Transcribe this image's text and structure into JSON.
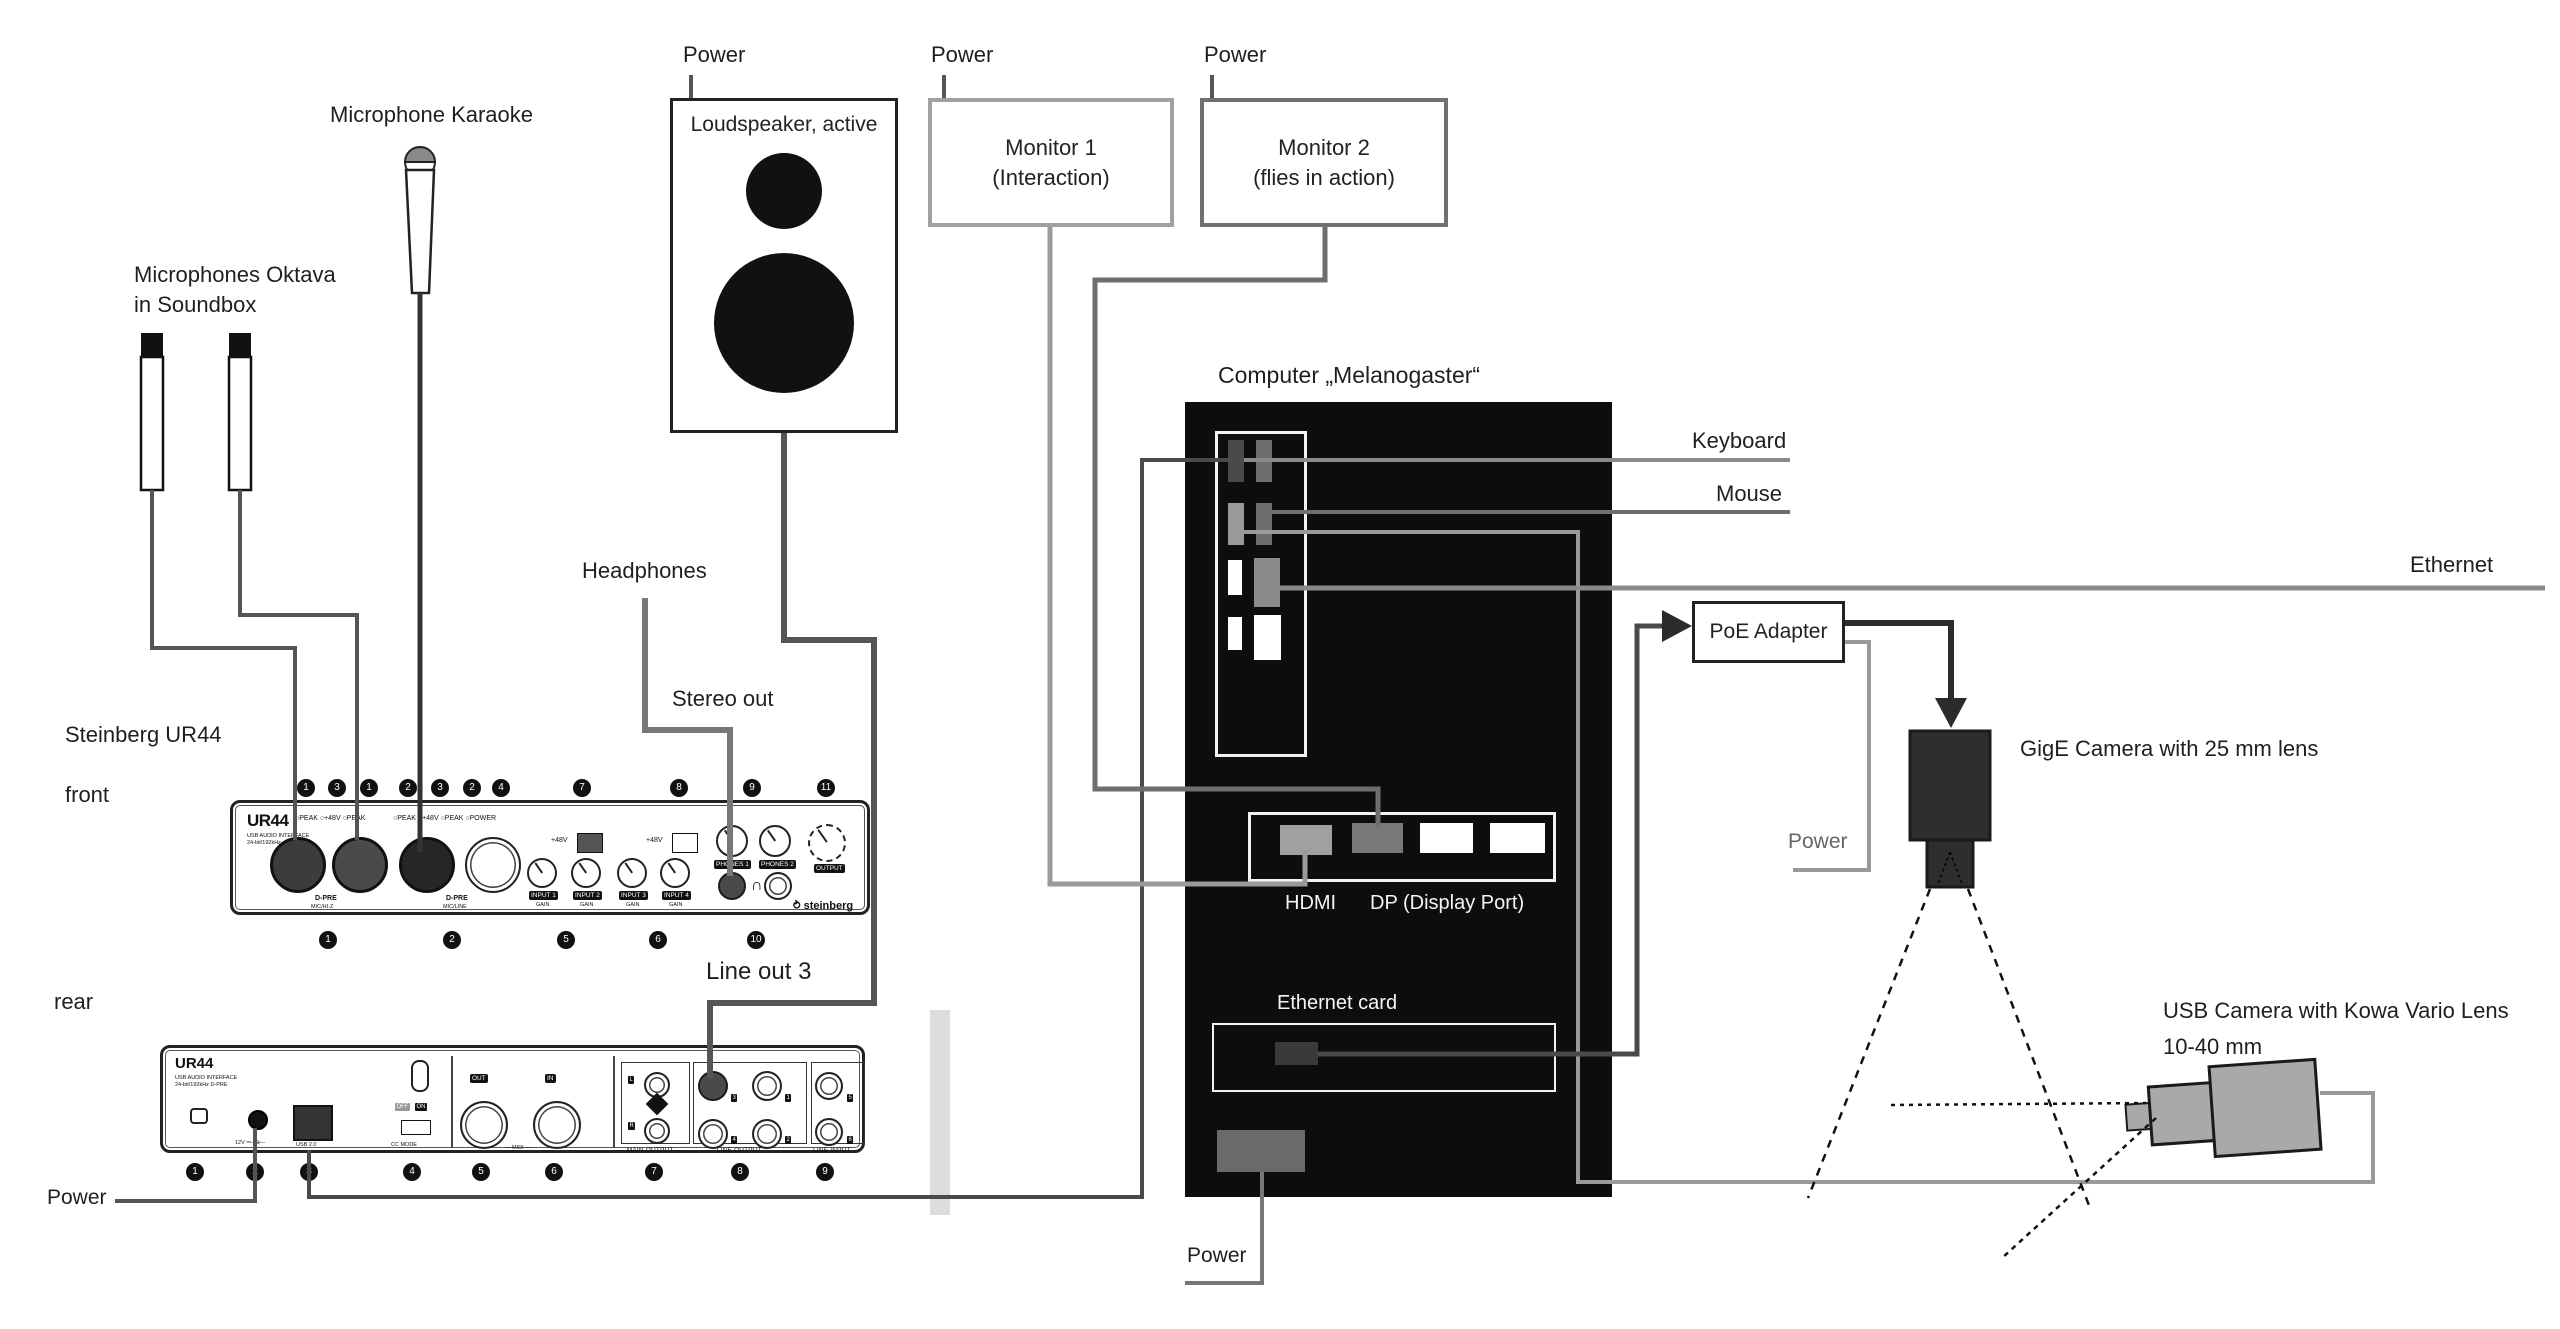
{
  "diagram_title": "Audio/video rig wiring diagram",
  "labels": {
    "mic_oktava_1": "Microphones Oktava",
    "mic_oktava_2": "in Soundbox",
    "mic_karaoke": "Microphone Karaoke",
    "loudspeaker": "Loudspeaker, active",
    "power": "Power",
    "monitor1_1": "Monitor 1",
    "monitor1_2": "(Interaction)",
    "monitor2_1": "Monitor 2",
    "monitor2_2": "(flies in action)",
    "computer": "Computer „Melanogaster“",
    "keyboard": "Keyboard",
    "mouse": "Mouse",
    "ethernet": "Ethernet",
    "poe": "PoE Adapter",
    "gige_camera": "GigE Camera with 25 mm lens",
    "usb_camera_1": "USB Camera with Kowa Vario Lens",
    "usb_camera_2": "10-40 mm",
    "steinberg": "Steinberg UR44",
    "front": "front",
    "rear": "rear",
    "headphones": "Headphones",
    "stereo_out": "Stereo out",
    "line_out_3": "Line out 3",
    "hdmi": "HDMI",
    "dp": "DP (Display Port)",
    "ethernet_card": "Ethernet card"
  },
  "front_panel": {
    "brand": "UR44",
    "brand_sub1": "USB AUDIO INTERFACE",
    "brand_sub2": "24-bit/192kHz",
    "leds_left": "○PEAK ○+48V ○PEAK",
    "leds_right": "○PEAK ○+48V ○PEAK ○POWER",
    "dpre": "D-PRE",
    "mic_hiz": "MIC/HI-Z",
    "mic_line": "MIC/LINE",
    "p48v": "+48V",
    "input1": "INPUT 1",
    "input2": "INPUT 2",
    "input3": "INPUT 3",
    "input4": "INPUT 4",
    "gain": "GAIN",
    "phones1": "PHONES 1",
    "phones2": "PHONES 2",
    "output": "OUTPUT",
    "phones_glyph": "∩",
    "logo": "steinberg"
  },
  "rear_panel": {
    "brand": "UR44",
    "brand_sub1": "USB AUDIO INTERFACE",
    "brand_sub2": "24-bit/192kHz D-PRE",
    "dc": "12V ⎓—⊕—",
    "usb": "USB 2.0",
    "off": "OFF",
    "on": "ON",
    "cc_mode": "CC MODE",
    "midi_out": "OUT",
    "midi_in": "IN",
    "midi": "— MIDI —",
    "l": "L",
    "r": "R",
    "main_output": "— MAIN OUTPUT —",
    "line_output": "— LINE OUTPUT —",
    "line_input": "LINE INPUT",
    "jack3": "3",
    "jack1": "1",
    "jack4": "4",
    "jack2": "2",
    "jack5": "5",
    "jack6": "6",
    "screw": "⊕"
  },
  "callouts": {
    "front_top": [
      "1",
      "3",
      "1",
      "2",
      "3",
      "2",
      "4",
      "7",
      "8",
      "9",
      "11"
    ],
    "front_bottom": [
      "1",
      "2",
      "5",
      "6",
      "10"
    ],
    "rear": [
      "1",
      "2",
      "3",
      "4",
      "5",
      "6",
      "7",
      "8",
      "9"
    ]
  },
  "colors": {
    "cable_dark": "#4a4a4a",
    "cable_mid": "#6e6e6e",
    "cable_light": "#9a9a9a",
    "ethernet_line": "#8a8a8a",
    "monitor1_border": "#a0a0a0",
    "monitor2_border": "#707070",
    "computer_bg": "#0d0d0d",
    "gige_body": "#2e2e2e",
    "usbcam_body": "#a9a9a9",
    "hdmi_port": "#a0a0a0",
    "dp_port": "#787878",
    "ethernet_port": "#8a8a8a"
  }
}
